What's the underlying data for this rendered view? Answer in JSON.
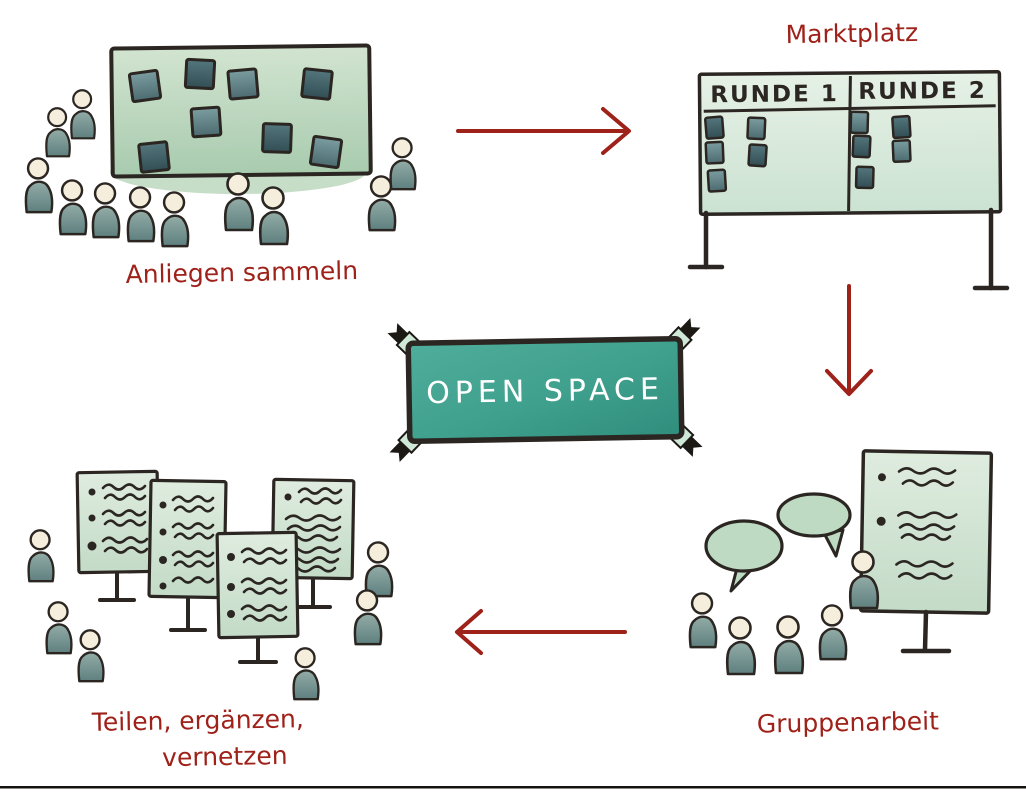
{
  "banner": {
    "text": "OPEN SPACE"
  },
  "steps": {
    "anliegen": {
      "label": "Anliegen sammeln"
    },
    "marktplatz": {
      "label": "Marktplatz",
      "columns": {
        "col1": "RUNDE 1",
        "col2": "RUNDE 2"
      }
    },
    "gruppenarbeit": {
      "label": "Gruppenarbeit"
    },
    "teilen": {
      "label_line1": "Teilen, ergänzen,",
      "label_line2": "vernetzen"
    }
  },
  "flow": {
    "arrows": [
      "anliegen-sammeln -> marktplatz",
      "marktplatz -> gruppenarbeit",
      "gruppenarbeit -> teilen-vernetzen"
    ]
  },
  "colors": {
    "accent_red": "#9e211a",
    "banner_teal": "#3fa08d",
    "board_green": "#b9d6bd",
    "mint_board": "#d8eada",
    "sticky_note_dark": "#44646a",
    "person_body": "#6f8f8d",
    "person_head": "#f6eedc",
    "outline_ink": "#2b2622"
  }
}
